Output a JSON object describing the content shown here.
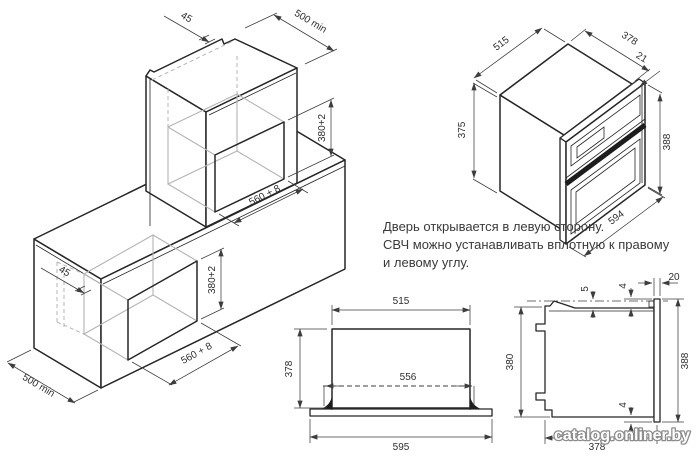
{
  "figures": {
    "niche_iso": {
      "dims": {
        "upper_clearance": "45",
        "upper_depth": "500 min",
        "upper_height": "380+2",
        "upper_width": "560 + 8",
        "lower_clearance": "45",
        "lower_height": "380+2",
        "lower_width": "560 + 8",
        "lower_depth": "500 min"
      }
    },
    "oven_iso": {
      "dims": {
        "body_width": "515",
        "body_depth": "378",
        "door_offset": "21",
        "door_height": "388",
        "body_height": "375",
        "door_width": "594"
      }
    },
    "top_view": {
      "dims": {
        "body_width": "515",
        "body_depth": "378",
        "clip_width": "556",
        "door_width": "595"
      }
    },
    "side_view": {
      "dims": {
        "door_thickness": "20",
        "top_gap": "4",
        "top_clearance": "5",
        "body_height": "380",
        "front_height": "388",
        "bottom_gap": "4",
        "body_depth": "378"
      }
    }
  },
  "notes": {
    "line1": "Дверь открывается в левую сторону.",
    "line2": "СВЧ можно устанавливать вплотную к правому",
    "line3": "и левому углу."
  },
  "watermark": "catalog.onliner.by"
}
